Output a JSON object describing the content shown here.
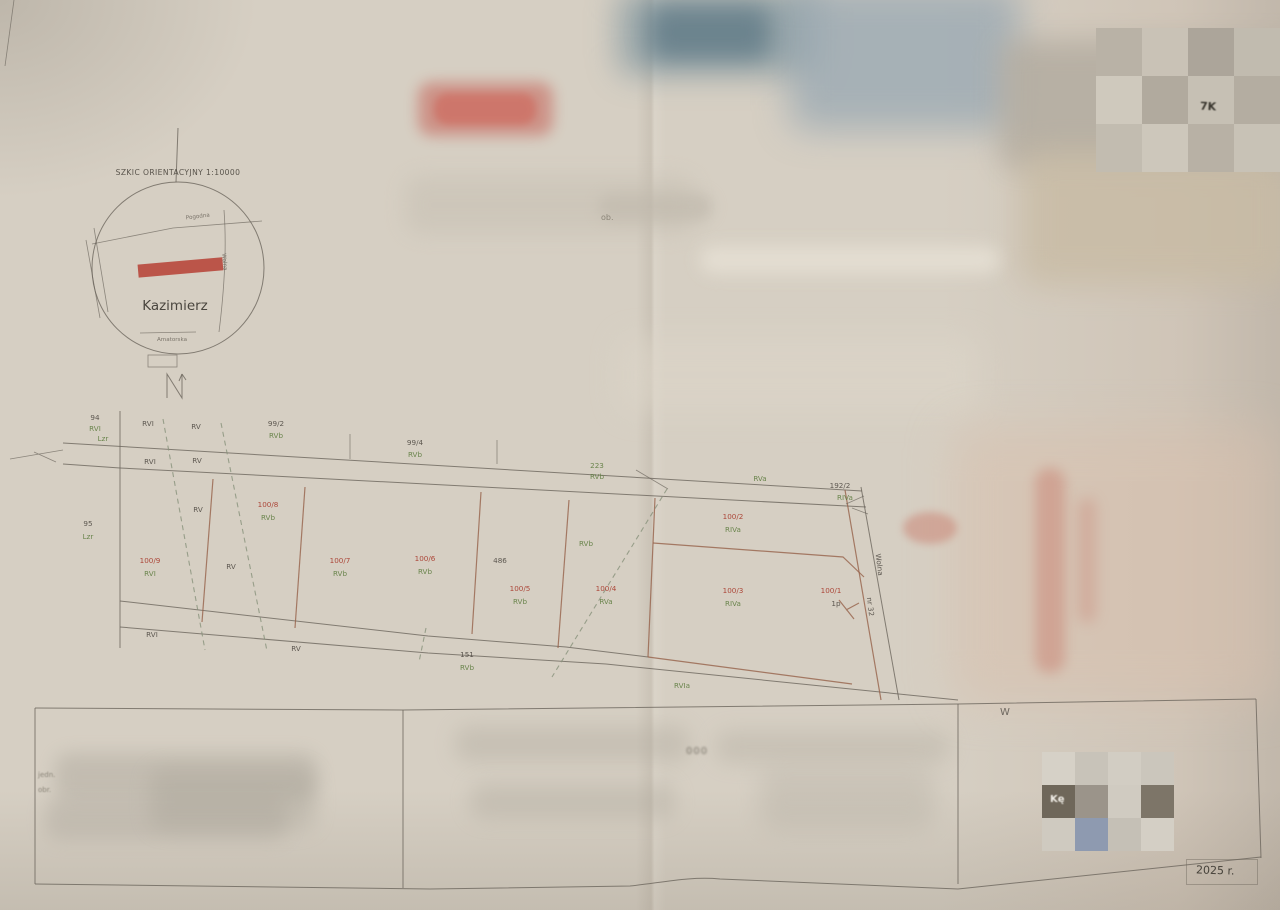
{
  "inset": {
    "title": "SZKIC ORIENTACYJNY 1:10000",
    "place": "Kazimierz",
    "street_top": "Pogodna",
    "street_right": "Wolna",
    "street_bottom": "Amatorska"
  },
  "fragments": {
    "top_right": "7K",
    "bottom_header": "W",
    "obreb": "ob.",
    "left_line1": "jedn.",
    "left_line2": "obr.",
    "scale": "000",
    "year": "2025 r.",
    "bottom_right": "Kę"
  },
  "map": {
    "colors": {
      "parcel_new": "#a8392b",
      "soil_class": "#5f7d40",
      "ink": "#504b44",
      "parcel_line": "#96624a"
    },
    "labels": [
      {
        "t": "94",
        "x": 95,
        "y": 420,
        "c": "link"
      },
      {
        "t": "RVI",
        "x": 95,
        "y": 431,
        "c": "lcls"
      },
      {
        "t": "RVI",
        "x": 148,
        "y": 426,
        "c": "link"
      },
      {
        "t": "RV",
        "x": 196,
        "y": 429,
        "c": "link"
      },
      {
        "t": "99/2",
        "x": 276,
        "y": 426,
        "c": "link"
      },
      {
        "t": "RVb",
        "x": 276,
        "y": 438,
        "c": "lcls"
      },
      {
        "t": "99/4",
        "x": 415,
        "y": 445,
        "c": "link"
      },
      {
        "t": "RVb",
        "x": 415,
        "y": 457,
        "c": "lcls"
      },
      {
        "t": "Lzr",
        "x": 103,
        "y": 441,
        "c": "lcls"
      },
      {
        "t": "RVI",
        "x": 150,
        "y": 464,
        "c": "link"
      },
      {
        "t": "RV",
        "x": 197,
        "y": 463,
        "c": "link"
      },
      {
        "t": "223",
        "x": 597,
        "y": 468,
        "c": "lcls"
      },
      {
        "t": "RVb",
        "x": 597,
        "y": 479,
        "c": "lcls"
      },
      {
        "t": "RVa",
        "x": 760,
        "y": 481,
        "c": "lcls"
      },
      {
        "t": "192/2",
        "x": 840,
        "y": 488,
        "c": "link"
      },
      {
        "t": "RIVa",
        "x": 845,
        "y": 500,
        "c": "lcls"
      },
      {
        "t": "95",
        "x": 88,
        "y": 526,
        "c": "link"
      },
      {
        "t": "Lzr",
        "x": 88,
        "y": 539,
        "c": "lcls"
      },
      {
        "t": "RV",
        "x": 198,
        "y": 512,
        "c": "link"
      },
      {
        "t": "100/8",
        "x": 268,
        "y": 507,
        "c": "lred"
      },
      {
        "t": "RVb",
        "x": 268,
        "y": 520,
        "c": "lcls"
      },
      {
        "t": "100/9",
        "x": 150,
        "y": 563,
        "c": "lred"
      },
      {
        "t": "RVI",
        "x": 150,
        "y": 576,
        "c": "lcls"
      },
      {
        "t": "RV",
        "x": 231,
        "y": 569,
        "c": "link"
      },
      {
        "t": "100/7",
        "x": 340,
        "y": 563,
        "c": "lred"
      },
      {
        "t": "RVb",
        "x": 340,
        "y": 576,
        "c": "lcls"
      },
      {
        "t": "100/6",
        "x": 425,
        "y": 561,
        "c": "lred"
      },
      {
        "t": "RVb",
        "x": 425,
        "y": 574,
        "c": "lcls"
      },
      {
        "t": "486",
        "x": 500,
        "y": 563,
        "c": "link"
      },
      {
        "t": "RVb",
        "x": 586,
        "y": 546,
        "c": "lcls"
      },
      {
        "t": "100/5",
        "x": 520,
        "y": 591,
        "c": "lred"
      },
      {
        "t": "RVb",
        "x": 520,
        "y": 604,
        "c": "lcls"
      },
      {
        "t": "100/4",
        "x": 606,
        "y": 591,
        "c": "lred"
      },
      {
        "t": "RVa",
        "x": 606,
        "y": 604,
        "c": "lcls"
      },
      {
        "t": "100/2",
        "x": 733,
        "y": 519,
        "c": "lred"
      },
      {
        "t": "RIVa",
        "x": 733,
        "y": 532,
        "c": "lcls"
      },
      {
        "t": "100/3",
        "x": 733,
        "y": 593,
        "c": "lred"
      },
      {
        "t": "RIVa",
        "x": 733,
        "y": 606,
        "c": "lcls"
      },
      {
        "t": "100/1",
        "x": 831,
        "y": 593,
        "c": "lred"
      },
      {
        "t": "1p",
        "x": 836,
        "y": 606,
        "c": "link"
      },
      {
        "t": "RVI",
        "x": 152,
        "y": 637,
        "c": "link"
      },
      {
        "t": "RV",
        "x": 296,
        "y": 651,
        "c": "link"
      },
      {
        "t": "151",
        "x": 467,
        "y": 657,
        "c": "link"
      },
      {
        "t": "RVb",
        "x": 467,
        "y": 670,
        "c": "lcls"
      },
      {
        "t": "RVIa",
        "x": 682,
        "y": 688,
        "c": "lcls"
      },
      {
        "t": "Wolna",
        "x": 877,
        "y": 565,
        "c": "link",
        "rot": 83,
        "fs": 7
      },
      {
        "t": "nr 32",
        "x": 868,
        "y": 607,
        "c": "link",
        "rot": 83,
        "fs": 6
      }
    ]
  }
}
